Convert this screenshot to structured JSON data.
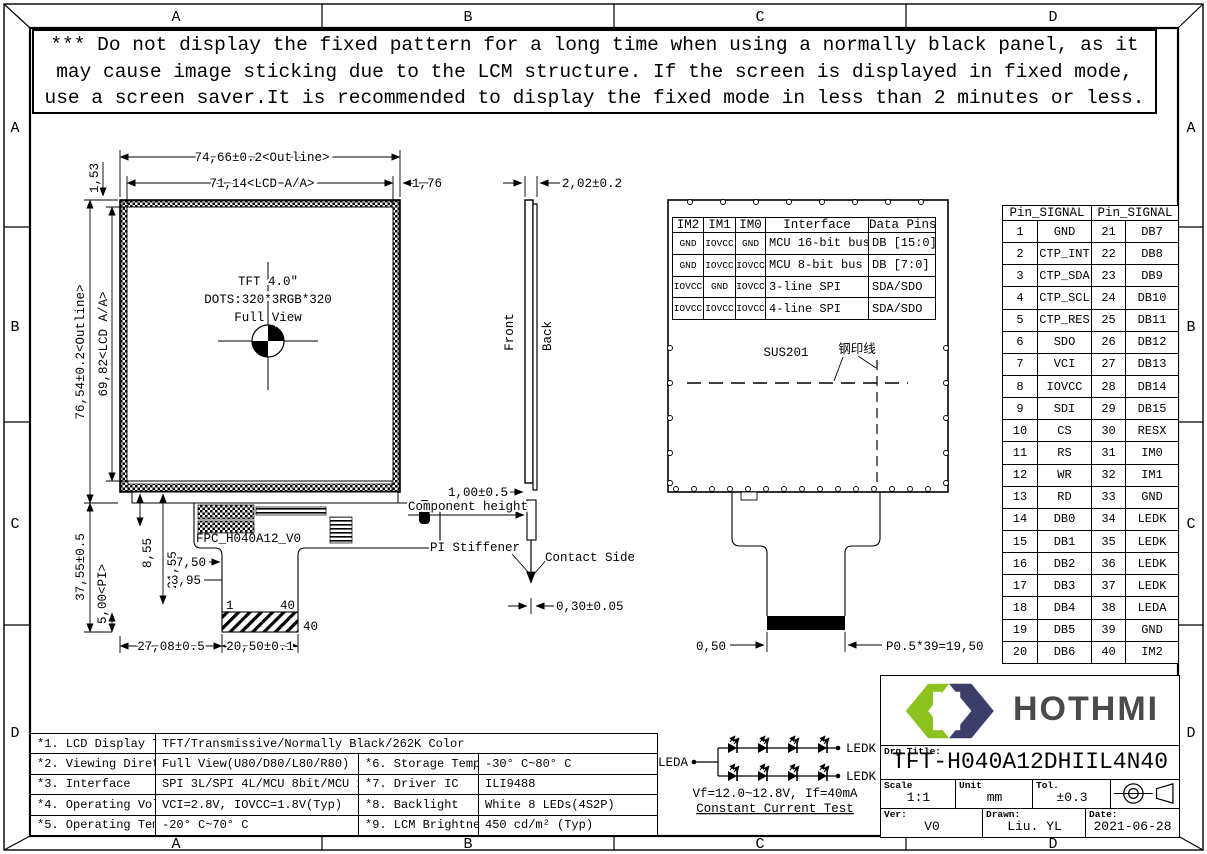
{
  "frame": {
    "top": [
      "A",
      "B",
      "C",
      "D"
    ],
    "bottom": [
      "A",
      "B",
      "C",
      "D"
    ],
    "left": [
      "A",
      "B",
      "C",
      "D"
    ],
    "right": [
      "A",
      "B",
      "C",
      "D"
    ]
  },
  "warning": {
    "lines": [
      "*** Do not display the fixed pattern for a long time when using a normally black panel, as it",
      "may cause image sticking due to the LCM structure. If the screen is displayed in fixed mode,",
      "use a screen saver.It is recommended to display the fixed mode in less than 2 minutes or less."
    ]
  },
  "front_view": {
    "dim_outline_w": "74,66±0.2<Outline>",
    "dim_lcd_w": "71,14<LCD A/A>",
    "dim_gap_right": "1,76",
    "dim_gap_top": "1,53",
    "dim_outline_h": "76,54±0.2<Outline>",
    "dim_lcd_h": "69,82<LCD A/A>",
    "center_line1": "TFT 4.0″",
    "center_line2": "DOTS:320*3RGB*320",
    "center_line3": "Full View",
    "fpc_label": "FPC_H040A12_V0",
    "single_layer_area": "单层区域",
    "dim_fpc_h": "37,55±0.5",
    "dim_pi": "5,00<PI>",
    "dim_855": "8,55",
    "dim_2155": "21,55",
    "dim_750": "7,50",
    "dim_395": "3,95",
    "pin_first": "1",
    "pin_last": "40",
    "connector_pins": "40",
    "dim_tail_x": "27,08±0.5",
    "dim_tail_w": "20,50±0.1"
  },
  "side_view": {
    "dim_thickness": "2,02±0.2",
    "front_label": "Front",
    "back_label": "Back",
    "dim_component": "1,00±0.5",
    "component_label": "Component height",
    "pi_label": "PI Stiffener",
    "contact_label": "Contact Side",
    "dim_fpc_t": "0,30±0.05"
  },
  "back_view": {
    "sus_label": "SUS201",
    "stamp_label": "钢印线",
    "dim_pitch1": "0,50",
    "dim_pitch_total": "P0.5*39=19,50",
    "im_table": {
      "headers": [
        "IM2",
        "IM1",
        "IM0",
        "Interface",
        "Data Pins"
      ],
      "rows": [
        [
          "GND",
          "IOVCC",
          "GND",
          "MCU 16-bit bus",
          "DB [15:0]"
        ],
        [
          "GND",
          "IOVCC",
          "IOVCC",
          "MCU 8-bit bus",
          "DB [7:0]"
        ],
        [
          "IOVCC",
          "GND",
          "IOVCC",
          "3-line SPI",
          "SDA/SDO"
        ],
        [
          "IOVCC",
          "IOVCC",
          "IOVCC",
          "4-line SPI",
          "SDA/SDO"
        ]
      ]
    }
  },
  "pin_table": {
    "header_left": "Pin_SIGNAL",
    "header_right": "Pin_SIGNAL",
    "rows": [
      [
        "1",
        "GND",
        "21",
        "DB7"
      ],
      [
        "2",
        "CTP_INT",
        "22",
        "DB8"
      ],
      [
        "3",
        "CTP_SDA",
        "23",
        "DB9"
      ],
      [
        "4",
        "CTP_SCL",
        "24",
        "DB10"
      ],
      [
        "5",
        "CTP_RES",
        "25",
        "DB11"
      ],
      [
        "6",
        "SDO",
        "26",
        "DB12"
      ],
      [
        "7",
        "VCI",
        "27",
        "DB13"
      ],
      [
        "8",
        "IOVCC",
        "28",
        "DB14"
      ],
      [
        "9",
        "SDI",
        "29",
        "DB15"
      ],
      [
        "10",
        "CS",
        "30",
        "RESX"
      ],
      [
        "11",
        "RS",
        "31",
        "IM0"
      ],
      [
        "12",
        "WR",
        "32",
        "IM1"
      ],
      [
        "13",
        "RD",
        "33",
        "GND"
      ],
      [
        "14",
        "DB0",
        "34",
        "LEDK"
      ],
      [
        "15",
        "DB1",
        "35",
        "LEDK"
      ],
      [
        "16",
        "DB2",
        "36",
        "LEDK"
      ],
      [
        "17",
        "DB3",
        "37",
        "LEDK"
      ],
      [
        "18",
        "DB4",
        "38",
        "LEDA"
      ],
      [
        "19",
        "DB5",
        "39",
        "GND"
      ],
      [
        "20",
        "DB6",
        "40",
        "IM2"
      ]
    ]
  },
  "spec_table": {
    "r1": {
      "label": "*1. LCD Display Type",
      "value": "TFT/Transmissive/Normally Black/262K Color"
    },
    "r2": {
      "label": "*2. Viewing Diretion",
      "value": "Full View(U80/D80/L80/R80)",
      "label2": "*6. Storage Temp",
      "value2": "-30° C~80° C"
    },
    "r3": {
      "label": "*3. Interface",
      "value": "SPI 3L/SPI 4L/MCU 8bit/MCU 16bit",
      "label2": "*7. Driver IC",
      "value2": "ILI9488"
    },
    "r4": {
      "label": "*4. Operating Voltage",
      "value": "VCI=2.8V, IOVCC=1.8V(Typ)",
      "label2": "*8. Backlight",
      "value2": "White 8 LEDs(4S2P)"
    },
    "r5": {
      "label": "*5. Operating Temp",
      "value": "-20° C~70° C",
      "label2": "*9. LCM Brightness",
      "value2": "450 cd/m² (Typ)"
    }
  },
  "led_circuit": {
    "anode": "LEDA",
    "cathode1": "LEDK",
    "cathode2": "LEDK",
    "spec": "Vf=12.0~12.8V, If=40mA",
    "test": "Constant Current Test"
  },
  "title_block": {
    "brand": "HOTHMI",
    "drg_title_label": "Drg Title:",
    "drg_title": "TFT-H040A12DHIIL4N40",
    "scale_label": "Scale",
    "scale": "1:1",
    "unit_label": "Unit",
    "unit": "mm",
    "tol_label": "Tol.",
    "tol": "±0.3",
    "ver_label": "Ver:",
    "ver": "V0",
    "drawn_label": "Drawn:",
    "drawn": "Liu. YL",
    "date_label": "Date:",
    "date": "2021-06-28"
  },
  "colors": {
    "logo_green": "#8dc21f",
    "logo_navy": "#3b3e6b",
    "brand_gray": "#4a4a4a"
  }
}
